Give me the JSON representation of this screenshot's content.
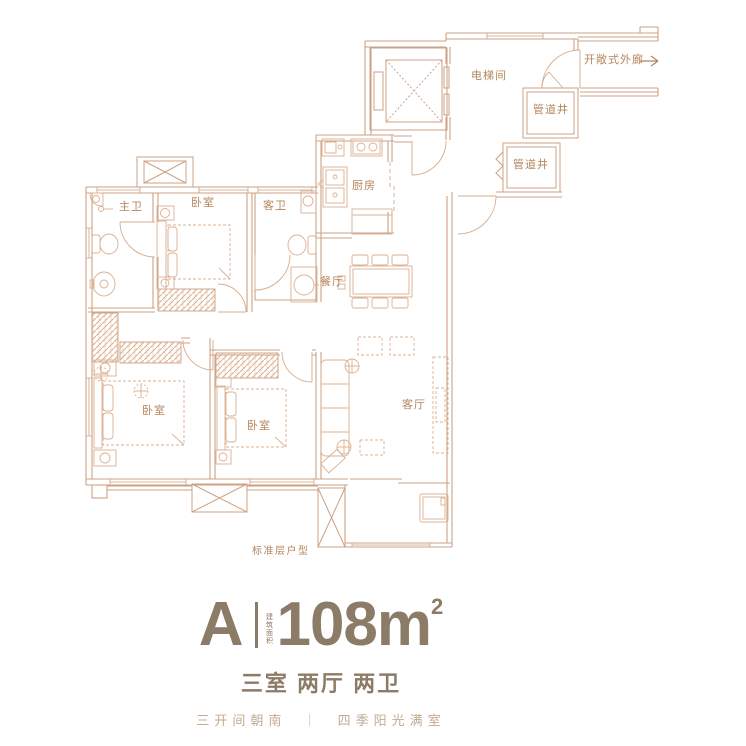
{
  "colors": {
    "wall_line": "#cda183",
    "furniture_line": "#dcb091",
    "label_text": "#b5855c",
    "title_text": "#8c7b67",
    "tagline_text": "#c2aa92"
  },
  "floorplan": {
    "rooms": [
      {
        "id": "master-bath",
        "label": "主卫"
      },
      {
        "id": "bedroom-north",
        "label": "卧室"
      },
      {
        "id": "guest-bath",
        "label": "客卫"
      },
      {
        "id": "kitchen",
        "label": "厨房"
      },
      {
        "id": "dining-room",
        "label": "餐厅"
      },
      {
        "id": "elevator-hall",
        "label": "电梯间"
      },
      {
        "id": "pipe-shaft-upper",
        "label": "管道井"
      },
      {
        "id": "pipe-shaft-lower",
        "label": "管道井"
      },
      {
        "id": "open-corridor",
        "label": "开敞式外廊"
      },
      {
        "id": "bedroom-west",
        "label": "卧室"
      },
      {
        "id": "bedroom-middle",
        "label": "卧室"
      },
      {
        "id": "living-room",
        "label": "客厅"
      }
    ],
    "note": "标准层户型"
  },
  "footer": {
    "unit_letter": "A",
    "area_note_vertical": "建筑面积",
    "area_value": "108m",
    "area_superscript": "2",
    "layout_summary": "三室 两厅 两卫",
    "tagline_left": "三开间朝南",
    "tagline_divider": "｜",
    "tagline_right": "四季阳光满室"
  }
}
